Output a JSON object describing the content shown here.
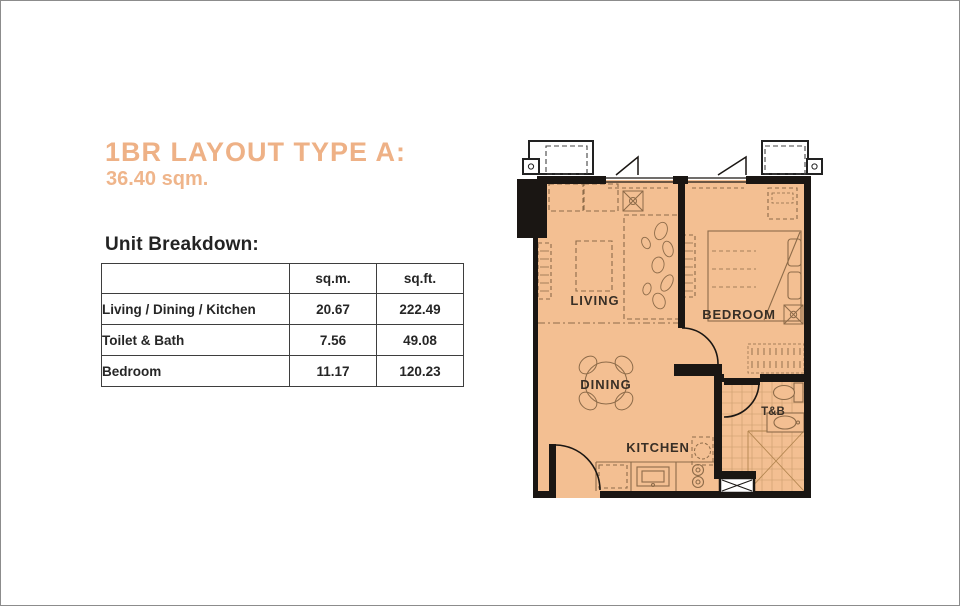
{
  "page": {
    "title": "1BR LAYOUT TYPE A:",
    "subtitle": "36.40 sqm.",
    "section_heading": "Unit Breakdown:"
  },
  "table": {
    "columns": [
      "",
      "sq.m.",
      "sq.ft."
    ],
    "rows": [
      {
        "label": "Living / Dining / Kitchen",
        "sqm": "20.67",
        "sqft": "222.49"
      },
      {
        "label": "Toilet & Bath",
        "sqm": "7.56",
        "sqft": "49.08"
      },
      {
        "label": "Bedroom",
        "sqm": "11.17",
        "sqft": "120.23"
      }
    ]
  },
  "floor_plan": {
    "room_labels": {
      "living": "LIVING",
      "bedroom": "BEDROOM",
      "dining": "DINING",
      "toilet_bath": "T&B",
      "kitchen": "KITCHEN"
    },
    "colors": {
      "accent_orange": "#eeb186",
      "floor_fill": "#f3bf92",
      "wall": "#1a1613",
      "furniture_line": "#8d6b49",
      "tile_line": "#ca9b6d",
      "table_border": "#3e3e3e"
    }
  }
}
